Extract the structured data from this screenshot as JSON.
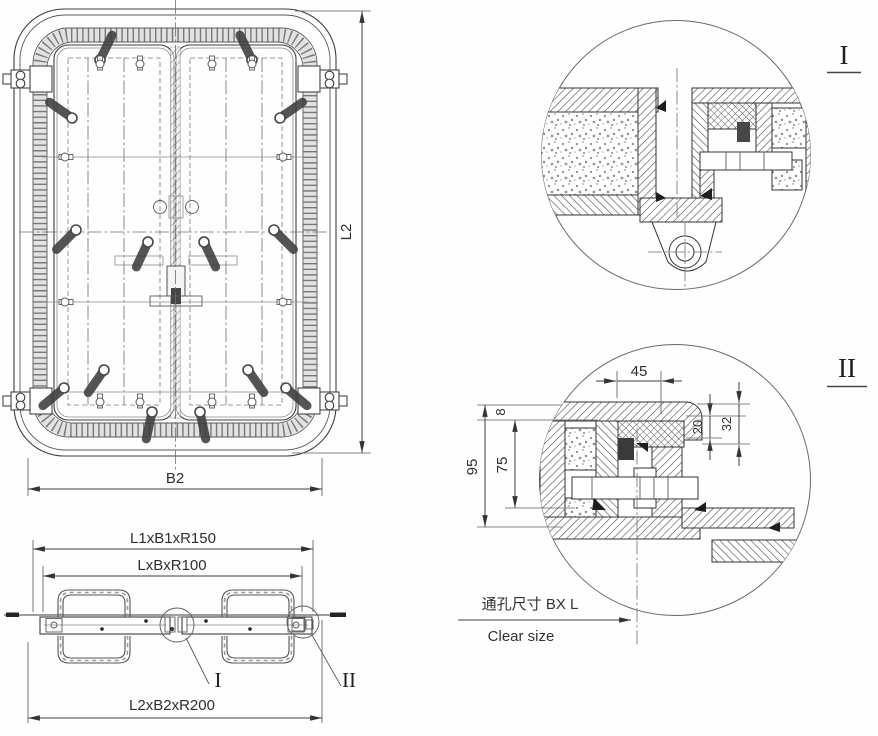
{
  "drawing": {
    "front_view": {
      "dim_height_label": "L2",
      "dim_width_label": "B2"
    },
    "plan_view": {
      "dim_frame_label": "L1xB1xR150",
      "dim_clear_label": "LxBxR100",
      "dim_outer_label": "L2xB2xR200",
      "detail1_marker": "I",
      "detail2_marker": "II"
    },
    "detail_1": {
      "title": "I"
    },
    "detail_2": {
      "title": "II",
      "dim_top_width": "45",
      "dim_lip": "8",
      "dim_inner_height": "75",
      "dim_outer_height": "95",
      "dim_gasket": "20",
      "dim_step": "32",
      "clear_size_zh": "通孔尺寸 BX L",
      "clear_size_en": "Clear size"
    },
    "colors": {
      "line": "#3d3d3d",
      "dimension": "#404040",
      "text": "#2e2e2e",
      "background": "#fffefe"
    }
  }
}
